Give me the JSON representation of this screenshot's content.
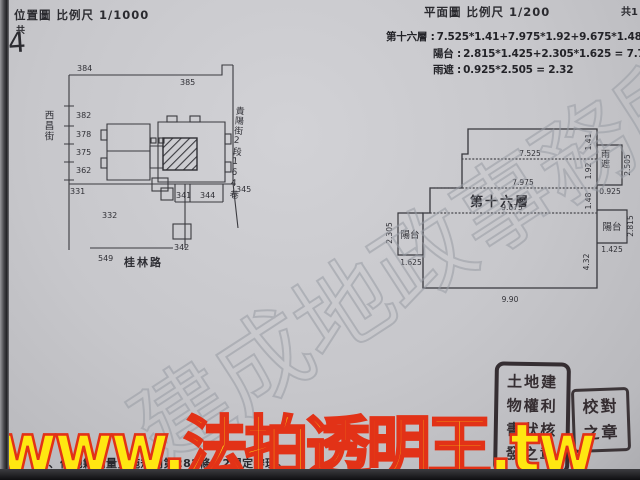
{
  "headers": {
    "location_title": "位置圖 比例尺 1/1000",
    "sheet_char": "共",
    "sheet_number": "4",
    "plan_title": "平面圖 比例尺 1/200",
    "plan_sheet": "共1"
  },
  "calculations": {
    "floor_label": "第十六層 :",
    "floor_expr": "7.525*1.41+7.975*1.92+9.675*1.48+9.90*4.32 = 8",
    "balcony_label": "陽台 :",
    "balcony_expr": "2.815*1.425+2.305*1.625 = 7.76",
    "rain_label": "雨遮 :",
    "rain_expr": "0.925*2.505 = 2.32"
  },
  "location_map": {
    "streets": {
      "left": "西昌街",
      "bottom": "桂林路",
      "right": "貴陽街2段164巷"
    },
    "lots": {
      "l384": "384",
      "l385": "385",
      "l382": "382",
      "l378": "378",
      "l375": "375",
      "l362": "362",
      "l331": "331",
      "l332": "332",
      "l341": "341",
      "l342": "342",
      "l344": "344",
      "l345": "345",
      "l549": "549"
    }
  },
  "floor_plan": {
    "unit_label": "第十六層",
    "balcony_left": "陽台",
    "balcony_right": "陽台",
    "rain_cover": "雨遮",
    "dims": {
      "top": "7.525",
      "mid": "7.975",
      "lower": "9.675",
      "bottom": "9.90",
      "r1": "1.41",
      "r2": "1.92",
      "r3": "1.48",
      "r4": "4.32",
      "rc_h": "2.505",
      "rc_w": "0.925",
      "br_h": "2.815",
      "br_w": "1.425",
      "bl_h": "2.305",
      "bl_w": "1.625"
    }
  },
  "seals": {
    "large_text": "土地建物權利書狀核發之章",
    "small_text": "校對之章"
  },
  "footer": {
    "note": "一、依地籍測量實施規則第282條之2規定辦理。"
  },
  "watermarks": {
    "diagonal": "建成地政事務所",
    "banner": "www.法拍透明王.tw"
  },
  "colors": {
    "paper": "#c7c7cb",
    "ink": "#2e2e33",
    "banner_fill": "#ffe711",
    "banner_stroke": "#e23217",
    "seal": "#2b2327"
  }
}
